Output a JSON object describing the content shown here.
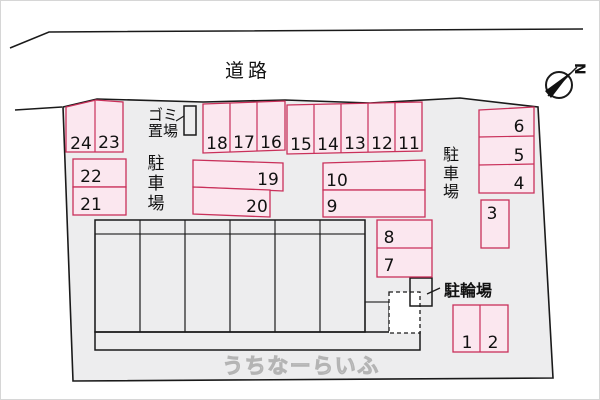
{
  "labels": {
    "road": "道路",
    "garbage": [
      "ゴミ",
      "置場"
    ],
    "parking": [
      "駐",
      "車",
      "場"
    ],
    "bicycle": "駐輪場",
    "north": "N",
    "watermark": "うちなーらいふ"
  },
  "spaces": {
    "s1": "1",
    "s2": "2",
    "s3": "3",
    "s4": "4",
    "s5": "5",
    "s6": "6",
    "s7": "7",
    "s8": "8",
    "s9": "9",
    "s10": "10",
    "s11": "11",
    "s12": "12",
    "s13": "13",
    "s14": "14",
    "s15": "15",
    "s16": "16",
    "s17": "17",
    "s18": "18",
    "s19": "19",
    "s20": "20",
    "s21": "21",
    "s22": "22",
    "s23": "23",
    "s24": "24"
  },
  "colors": {
    "ground": "#ededee",
    "space_fill": "#fbe7ef",
    "space_border": "#c9305a",
    "building_unit_fill": "#fcf6c5",
    "outline": "#1a1a1a"
  }
}
